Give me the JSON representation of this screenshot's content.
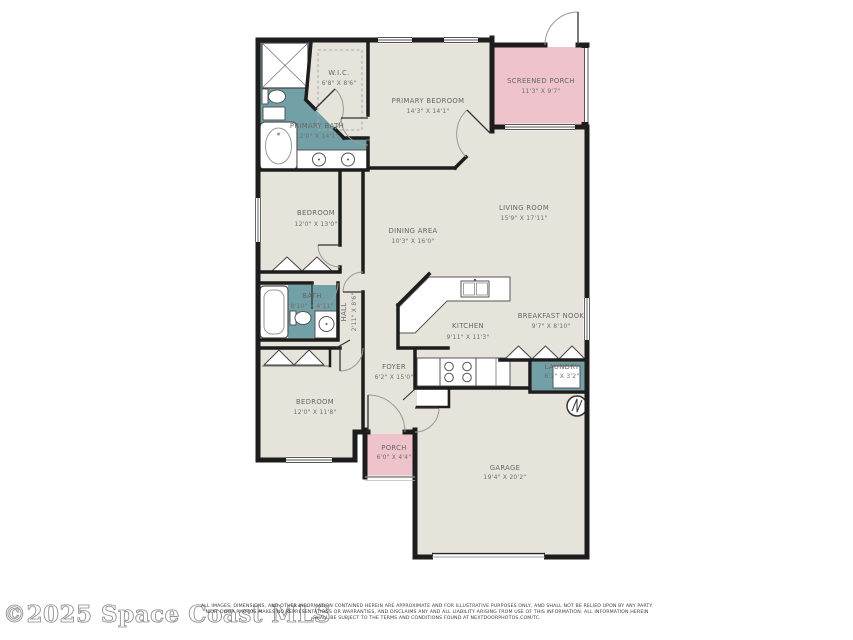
{
  "page": {
    "background": "#ffffff"
  },
  "plan": {
    "colors": {
      "walls": "#1d1d1d",
      "floor": "#e5e3da",
      "wet_rooms_teal": "#71a1a7",
      "porch_pink": "#efc3cb",
      "fixture_white": "#ffffff"
    },
    "rooms": [
      {
        "id": "wic",
        "name": "W.I.C.",
        "dims": "6'8\" X 8'6\""
      },
      {
        "id": "primary-bedroom",
        "name": "PRIMARY BEDROOM",
        "dims": "14'3\" X 14'1\""
      },
      {
        "id": "screened-porch",
        "name": "SCREENED PORCH",
        "dims": "11'3\" X 9'7\""
      },
      {
        "id": "primary-bath",
        "name": "PRIMARY BATH",
        "dims": "12'0\" X 14'1\""
      },
      {
        "id": "bedroom-upper",
        "name": "BEDROOM",
        "dims": "12'0\" X 13'0\""
      },
      {
        "id": "dining-area",
        "name": "DINING AREA",
        "dims": "10'3\" X 16'0\""
      },
      {
        "id": "living-room",
        "name": "LIVING ROOM",
        "dims": "15'9\" X 17'11\""
      },
      {
        "id": "bath",
        "name": "BATH",
        "dims": "8'10\" X 4'11\""
      },
      {
        "id": "hall",
        "name": "HALL",
        "dims": "2'11\" X 8'6\""
      },
      {
        "id": "kitchen",
        "name": "KITCHEN",
        "dims": "9'11\" X 11'3\""
      },
      {
        "id": "breakfast-nook",
        "name": "BREAKFAST NOOK",
        "dims": "9'7\" X 8'10\""
      },
      {
        "id": "foyer",
        "name": "FOYER",
        "dims": "6'2\" X 15'0\""
      },
      {
        "id": "laundry",
        "name": "LAUNDRY",
        "dims": "6'2\" X 3'2\""
      },
      {
        "id": "bedroom-lower",
        "name": "BEDROOM",
        "dims": "12'0\" X 11'8\""
      },
      {
        "id": "porch",
        "name": "PORCH",
        "dims": "6'0\" X 4'4\""
      },
      {
        "id": "garage",
        "name": "GARAGE",
        "dims": "19'4\" X 20'2\""
      }
    ],
    "fixture_icons": [
      "shower-icon",
      "bathtub-icon",
      "toilet-icon",
      "double-vanity-icon",
      "kitchen-sink-icon",
      "range-icon",
      "washer-icon",
      "water-heater-icon",
      "bifold-closet-icon",
      "door-swing-icon",
      "window-icon"
    ]
  },
  "footer": {
    "watermark": "©2025 Space Coast MLS",
    "disclaimer": [
      "ALL IMAGES, DIMENSIONS, AND OTHER INFORMATION CONTAINED HEREIN ARE APPROXIMATE AND FOR ILLUSTRATIVE PURPOSES ONLY, AND SHALL NOT BE RELIED UPON BY ANY PARTY.",
      "NEXT DOOR PHOTOS MAKES NO REPRESENTATIONS OR WARRANTIES, AND DISCLAIMS ANY AND ALL LIABILITY ARISING FROM USE OF THIS INFORMATION. ALL INFORMATION HEREIN",
      "SHALL BE SUBJECT TO THE TERMS AND CONDITIONS FOUND AT NEXTDOORPHOTOS.COM/TC."
    ]
  }
}
